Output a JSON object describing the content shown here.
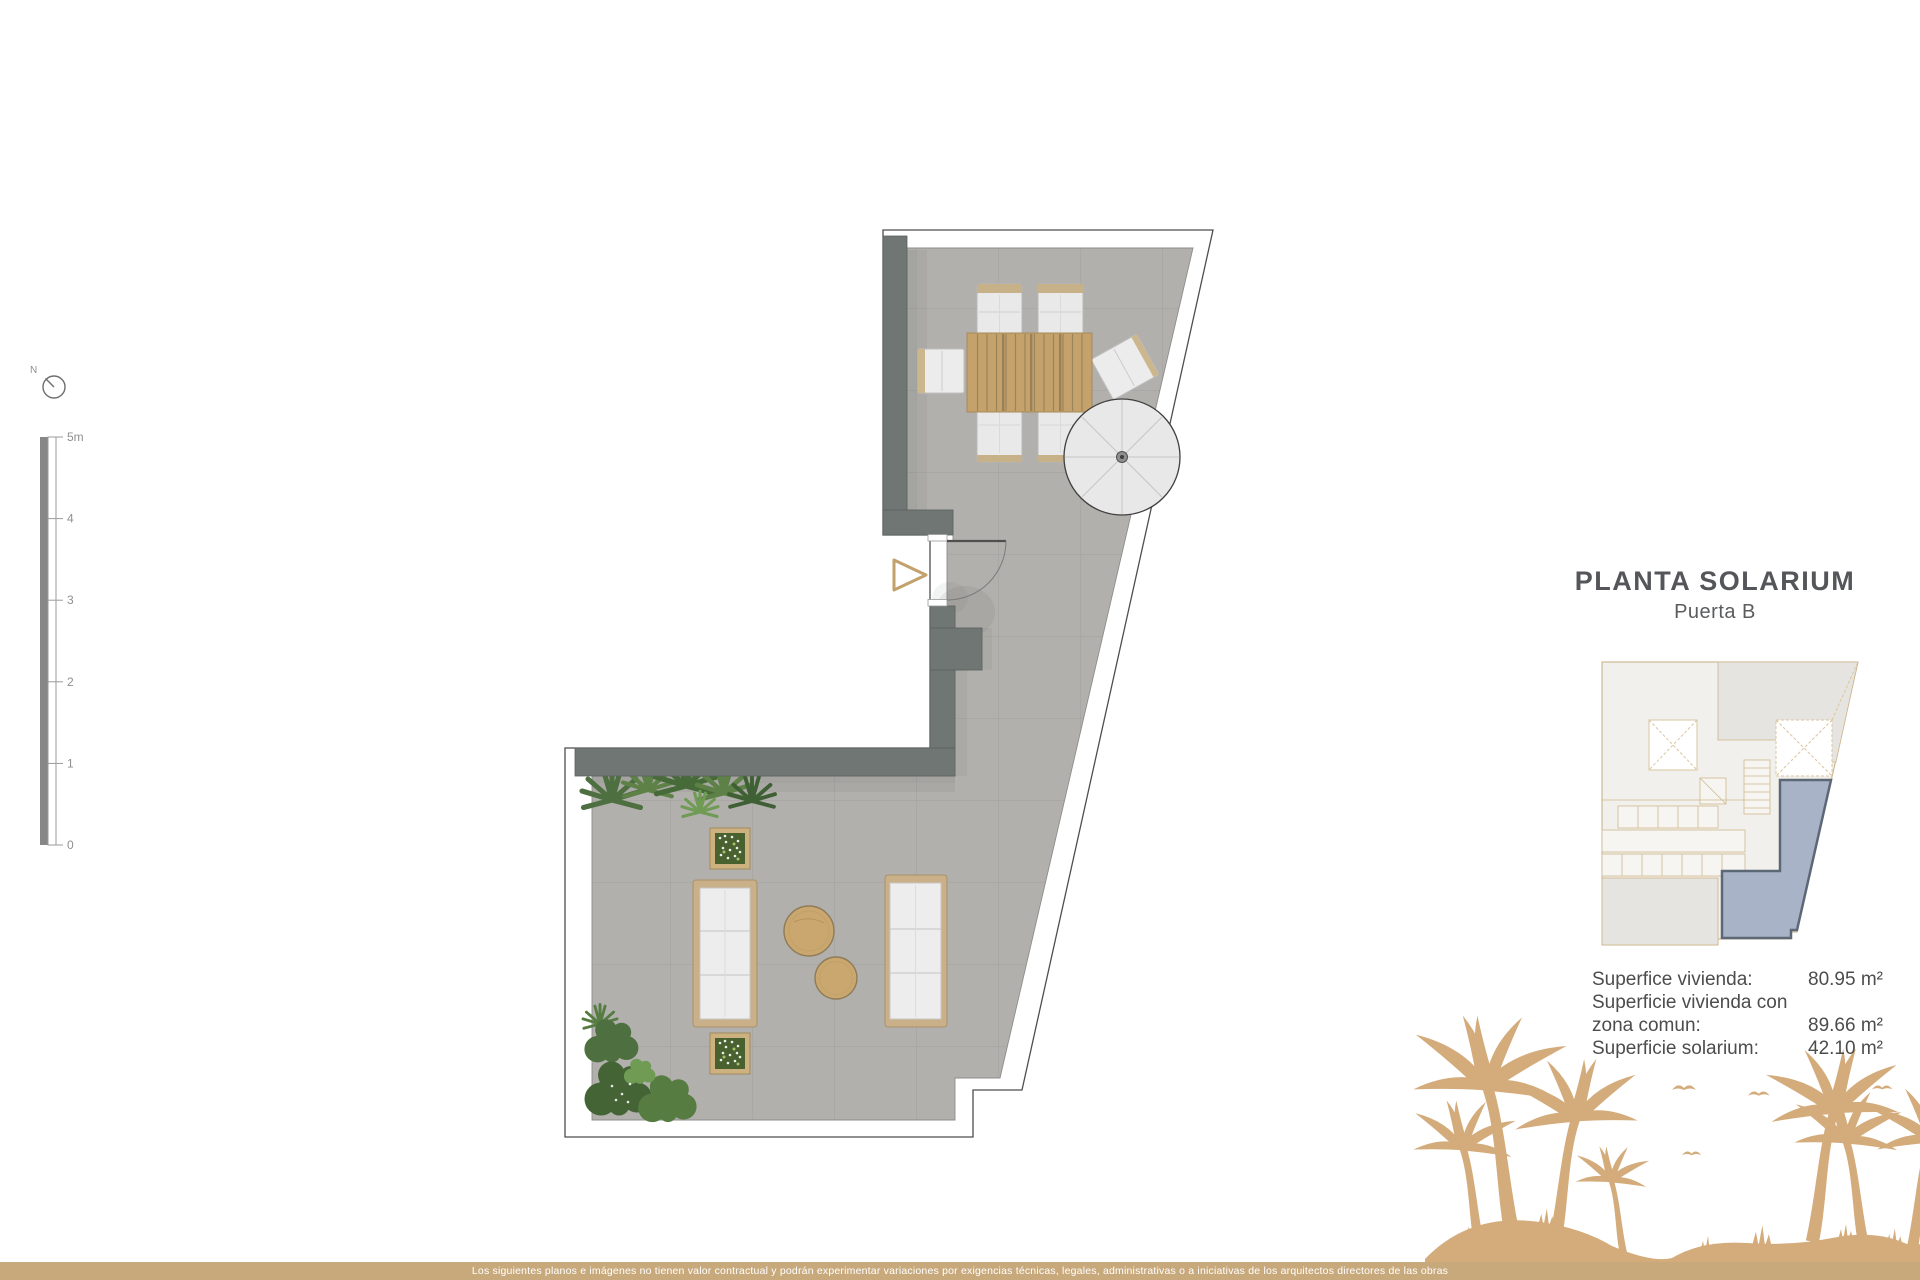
{
  "title": {
    "main": "PLANTA SOLARIUM",
    "sub": "Puerta B"
  },
  "compass": {
    "north_label": "N"
  },
  "scale_bar": {
    "label_5": "5m",
    "label_4": "4",
    "label_3": "3",
    "label_2": "2",
    "label_1": "1",
    "label_0": "0"
  },
  "areas": {
    "row1_label": "Superfice vivienda:",
    "row1_value": "80.95 m²",
    "row2_label": "Superficie vivienda con",
    "row3_label": "zona comun:",
    "row3_value": "89.66 m²",
    "row4_label": "Superficie solarium:",
    "row4_value": "42.10 m²"
  },
  "footer": {
    "disclaimer": "Los siguientes planos e imágenes no tienen valor contractual y podrán experimentar variaciones por exigencias técnicas, legales, administrativas o a iniciativas de los arquitectos directores de las obras"
  },
  "colors": {
    "accent_tan": "#c8a97c",
    "palm_tan": "#d4ac7c",
    "wall_gray": "#6f7673",
    "floor_gray": "#b2b0ad",
    "unit_highlight": "#a9b3c7",
    "unit_highlight_border": "#5d6877"
  }
}
